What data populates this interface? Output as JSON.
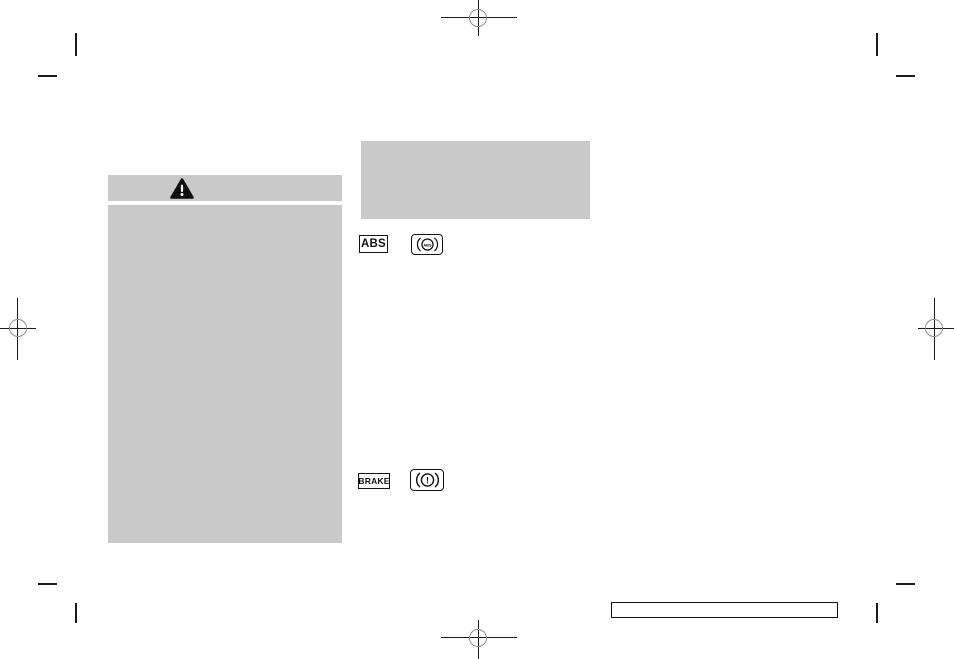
{
  "colors": {
    "page_background": "#ffffff",
    "redacted_block_gray": "#c9c9c9",
    "mark_ink": "#1a1a1a",
    "registration_ring_gray": "#8f8f8f"
  },
  "warning_panel": {
    "header_icon": "warning-triangle-icon"
  },
  "badges": {
    "abs_label": "ABS",
    "abs_lamp_text": "ABS",
    "brake_label": "BRAKE",
    "brake_lamp_text": "!"
  },
  "printer_marks": {
    "registration": [
      "top-center",
      "left-center",
      "right-center",
      "bottom-center"
    ],
    "crop_corners": [
      "top-left",
      "top-right",
      "bottom-left",
      "bottom-right"
    ]
  }
}
